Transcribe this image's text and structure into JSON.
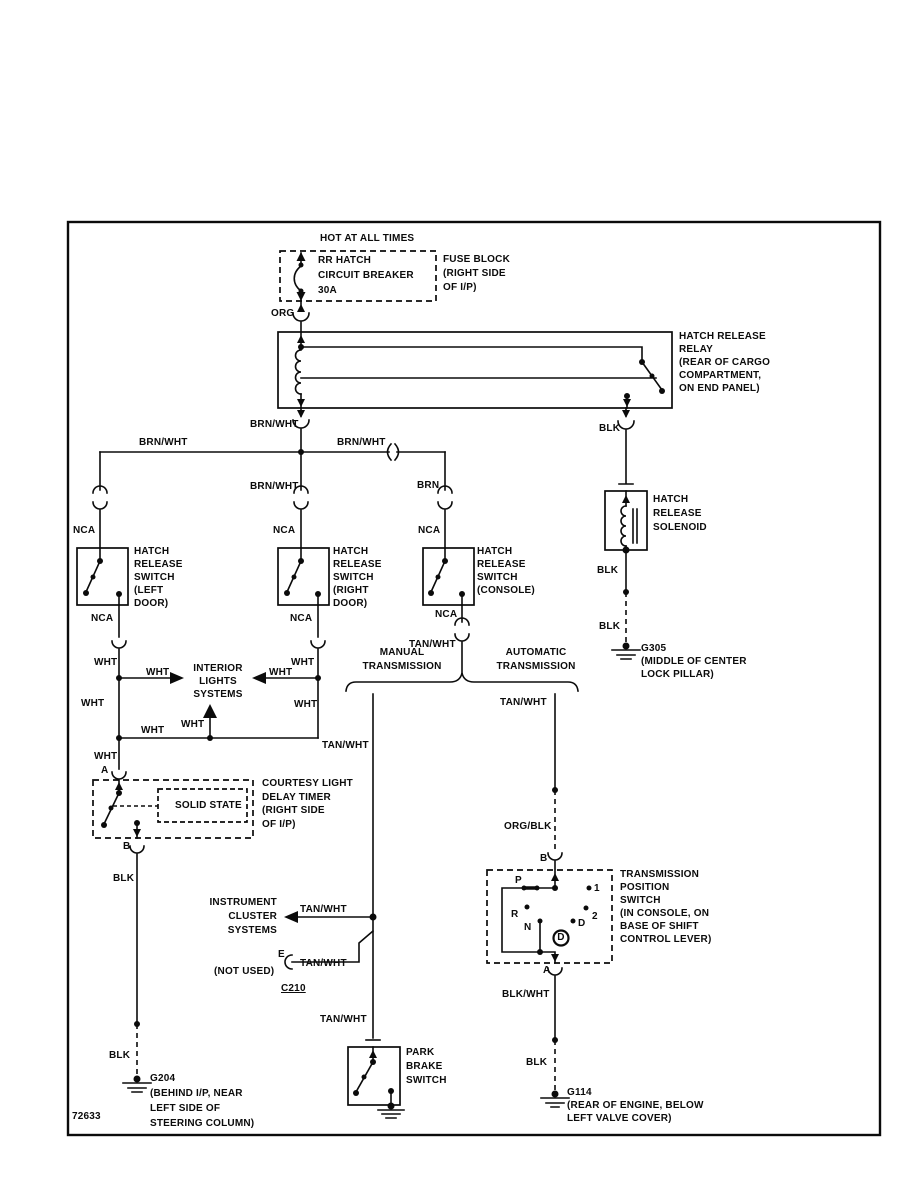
{
  "header": {
    "hot": "HOT AT ALL TIMES"
  },
  "fuse": {
    "breaker": "RR HATCH\nCIRCUIT BREAKER\n30A",
    "note": "FUSE BLOCK\n(RIGHT SIDE\nOF I/P)"
  },
  "relay": {
    "note": "HATCH RELEASE\nRELAY\n(REAR OF CARGO\nCOMPARTMENT,\nON END PANEL)"
  },
  "wires": {
    "org": "ORG",
    "brn_wht": "BRN/WHT",
    "brn": "BRN",
    "nca": "NCA",
    "wht": "WHT",
    "tan_wht": "TAN/WHT",
    "blk": "BLK",
    "org_blk": "ORG/BLK",
    "blk_wht": "BLK/WHT"
  },
  "terms": {
    "a": "A",
    "b": "B",
    "e": "E"
  },
  "sw_left": {
    "note": "HATCH\nRELEASE\nSWITCH\n(LEFT\nDOOR)"
  },
  "sw_right": {
    "note": "HATCH\nRELEASE\nSWITCH\n(RIGHT\nDOOR)"
  },
  "sw_console": {
    "note": "HATCH\nRELEASE\nSWITCH\n(CONSOLE)"
  },
  "solenoid": {
    "note": "HATCH\nRELEASE\nSOLENOID",
    "ground": "G305\n(MIDDLE OF CENTER\nLOCK PILLAR)"
  },
  "interior": {
    "title": "INTERIOR\nLIGHTS\nSYSTEMS"
  },
  "timer": {
    "solid_state": "SOLID STATE",
    "note": "COURTESY LIGHT\nDELAY TIMER\n(RIGHT SIDE\nOF I/P)",
    "ground": "G204\n(BEHIND I/P, NEAR\nLEFT SIDE OF\nSTEERING COLUMN)"
  },
  "split": {
    "manual": "MANUAL\nTRANSMISSION",
    "auto": "AUTOMATIC\nTRANSMISSION"
  },
  "cluster": {
    "title": "INSTRUMENT\nCLUSTER\nSYSTEMS",
    "not_used": "(NOT USED)",
    "c210": "C210"
  },
  "park": {
    "note": "PARK\nBRAKE\nSWITCH"
  },
  "tps": {
    "p": "P",
    "r": "R",
    "n": "N",
    "one": "1",
    "two": "2",
    "d": "D",
    "d_selected": "D",
    "note": "TRANSMISSION\nPOSITION\nSWITCH\n(IN CONSOLE, ON\nBASE OF SHIFT\nCONTROL LEVER)",
    "ground": "G114\n(REAR OF ENGINE, BELOW\nLEFT VALVE COVER)"
  },
  "footer": {
    "id": "72633"
  }
}
